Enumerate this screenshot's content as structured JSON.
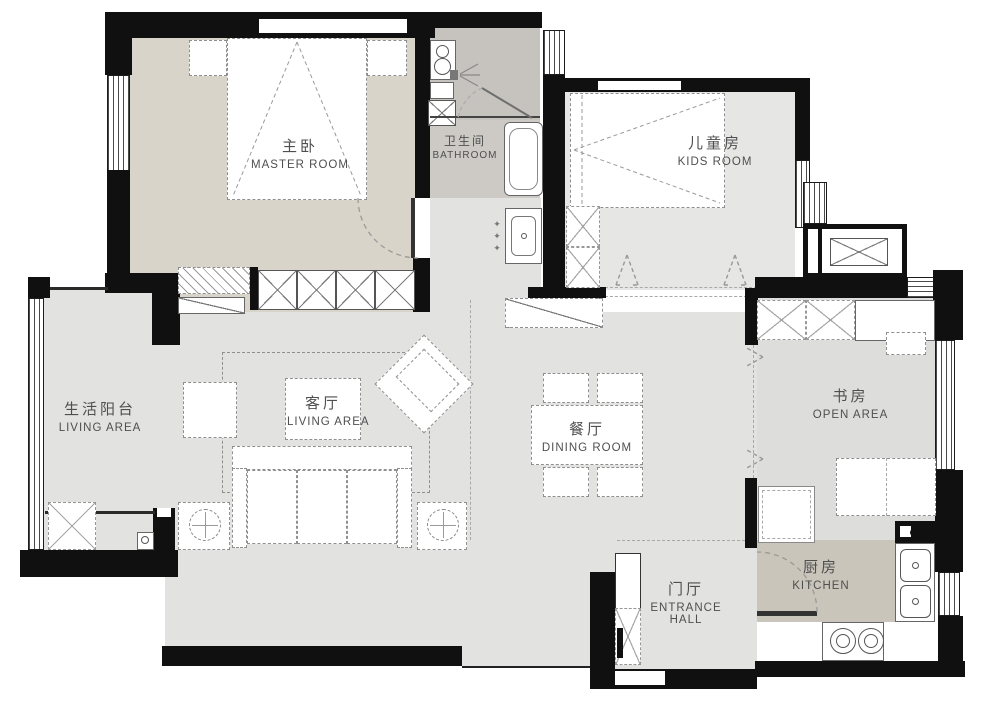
{
  "title": "apartment-floor-plan",
  "rooms": {
    "master": {
      "zh": "主卧",
      "en": "MASTER ROOM"
    },
    "bathroom": {
      "zh": "卫生间",
      "en": "BATHROOM"
    },
    "kids": {
      "zh": "儿童房",
      "en": "KIDS ROOM"
    },
    "balcony": {
      "zh": "生活阳台",
      "en": "LIVING AREA"
    },
    "living": {
      "zh": "客厅",
      "en": "LIVING AREA"
    },
    "dining": {
      "zh": "餐厅",
      "en": "DINING ROOM"
    },
    "study": {
      "zh": "书房",
      "en": "OPEN AREA"
    },
    "hall": {
      "zh": "门厅",
      "en": "ENTRANCE HALL"
    },
    "kitchen": {
      "zh": "厨房",
      "en": "KITCHEN"
    }
  },
  "icons": {
    "sparkle": "✦"
  },
  "colors": {
    "wall": "#101010",
    "floor_master": "#d8d4c9",
    "floor_bath_shower": "#c6c3be",
    "floor_bath": "#cdcac5",
    "floor_central": "#e2e2e1",
    "floor_kids": "#e6e6e5",
    "floor_study": "#dddddc",
    "floor_balcony": "#e2e2e1",
    "floor_kitchen": "#c9c5ba",
    "furniture_line": "#8f8f8f",
    "label_text": "#4f4f4f"
  }
}
